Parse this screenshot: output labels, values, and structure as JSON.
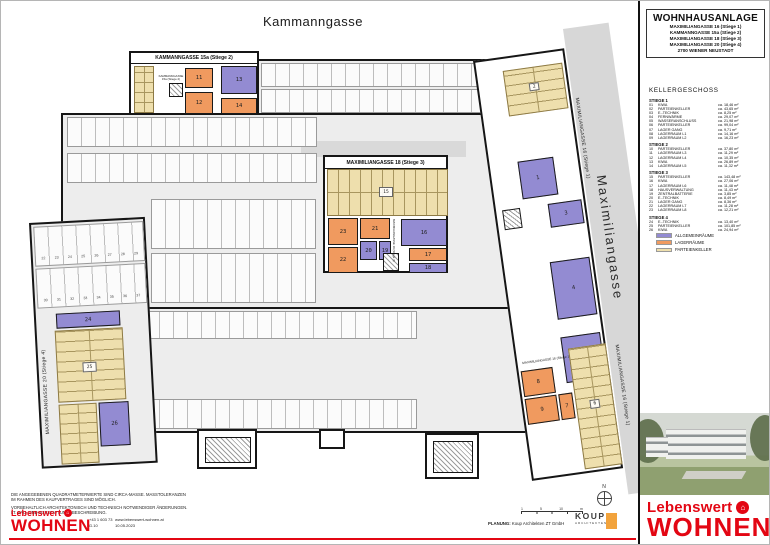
{
  "colors": {
    "c_allgemein": "#938bd2",
    "c_lager": "#f09a5f",
    "c_parteien": "#eedfad",
    "brand_red": "#e30613",
    "koup_orange": "#f2a33c"
  },
  "titleblock": {
    "title": "WOHNHAUSANLAGE",
    "address_lines": [
      "MAXIMILIANGASSE 16 (Stiege 1)",
      "KAMMANNGASSE 15a (Stiege 2)",
      "MAXIMILIANGASSE 18 (Stiege 3)",
      "MAXIMILIANGASSE 20 (Stiege 4)",
      "2700 WIENER NEUSTADT"
    ]
  },
  "room_schedule": {
    "heading": "KELLERGESCHOSS",
    "groups": [
      {
        "label": "STIEGE 1",
        "rooms": [
          {
            "nr": "01",
            "name": "KIWA",
            "area": "ca. 18,46 m²"
          },
          {
            "nr": "02",
            "name": "PARTEIENKELLER",
            "area": "ca. 43,65 m²"
          },
          {
            "nr": "03",
            "name": "E.-TECHNIK",
            "area": "ca. 8,25 m²"
          },
          {
            "nr": "04",
            "name": "FERNWÄRME",
            "area": "ca. 29,07 m²"
          },
          {
            "nr": "05",
            "name": "WASSERANSCHLUSS",
            "area": "ca. 21,98 m²"
          },
          {
            "nr": "06",
            "name": "PARTEIENKELLER",
            "area": "ca. 99,04 m²"
          },
          {
            "nr": "07",
            "name": "LAGER GANG",
            "area": "ca. 9,71 m²"
          },
          {
            "nr": "08",
            "name": "LAGERRAUM L1",
            "area": "ca. 14,16 m²"
          },
          {
            "nr": "09",
            "name": "LAGERRAUM L2",
            "area": "ca. 16,23 m²"
          }
        ]
      },
      {
        "label": "STIEGE 2",
        "rooms": [
          {
            "nr": "10",
            "name": "PARTEIENKELLER",
            "area": "ca. 37,80 m²"
          },
          {
            "nr": "11",
            "name": "LAGERRAUM L3",
            "area": "ca. 11,29 m²"
          },
          {
            "nr": "12",
            "name": "LAGERRAUM L4",
            "area": "ca. 10,35 m²"
          },
          {
            "nr": "13",
            "name": "KIWA",
            "area": "ca. 26,89 m²"
          },
          {
            "nr": "14",
            "name": "LAGERRAUM L5",
            "area": "ca. 11,32 m²"
          }
        ]
      },
      {
        "label": "STIEGE 3",
        "rooms": [
          {
            "nr": "15",
            "name": "PARTEIENKELLER",
            "area": "ca. 143,48 m²"
          },
          {
            "nr": "16",
            "name": "KIWA",
            "area": "ca. 27,06 m²"
          },
          {
            "nr": "17",
            "name": "LAGERRAUM L6",
            "area": "ca. 11,48 m²"
          },
          {
            "nr": "18",
            "name": "HAUSVERWALTUNG",
            "area": "ca. 11,43 m²"
          },
          {
            "nr": "19",
            "name": "ZENTRALBATTERIE",
            "area": "ca. 3,85 m²"
          },
          {
            "nr": "20",
            "name": "E.-TECHNIK",
            "area": "ca. 8,49 m²"
          },
          {
            "nr": "21",
            "name": "LAGER GANG",
            "area": "ca. 8,36 m²"
          },
          {
            "nr": "22",
            "name": "LAGERRAUM L7",
            "area": "ca. 11,28 m²"
          },
          {
            "nr": "23",
            "name": "LAGERRAUM L8",
            "area": "ca. 12,21 m²"
          }
        ]
      },
      {
        "label": "STIEGE 4",
        "rooms": [
          {
            "nr": "24",
            "name": "E.-TECHNIK",
            "area": "ca. 13,40 m²"
          },
          {
            "nr": "25",
            "name": "PARTEIENKELLER",
            "area": "ca. 101,85 m²"
          },
          {
            "nr": "26",
            "name": "KIWA",
            "area": "ca. 24,94 m²"
          }
        ]
      }
    ]
  },
  "legend": {
    "items": [
      {
        "label": "ALLGEMEINRÄUME",
        "color": "#938bd2"
      },
      {
        "label": "LAGERRÄUME",
        "color": "#f09a5f"
      },
      {
        "label": "PARTEIENKELLER",
        "color": "#eedfad"
      }
    ]
  },
  "plan": {
    "street_top": "Kammanngasse",
    "street_right": "Maximiliangasse",
    "edge_label": "MAXIMILIANGASSE 16 (Stiege 1)",
    "s2_header": "KAMMANNGASSE 15a (Stiege 2)",
    "s3_header": "MAXIMILIANGASSE 18 (Stiege 3)",
    "s4_label": "MAXIMILIANGASSE 20 (Stiege 4)",
    "north": "N",
    "rooms": {
      "r1": "1",
      "r2": "2",
      "r3": "3",
      "r4": "4",
      "r5": "5",
      "r6": "6",
      "r7": "7",
      "r8": "8",
      "r9": "9",
      "r11": "11",
      "r12": "12",
      "r13": "13",
      "r14": "14",
      "r15": "15",
      "r16": "16",
      "r17": "17",
      "r18": "18",
      "r19": "19",
      "r20": "20",
      "r21": "21",
      "r22": "22",
      "r23": "23",
      "r24": "24",
      "r25": "25",
      "r26": "26"
    },
    "parking_rows": [
      [
        "22",
        "23",
        "24",
        "25",
        "26",
        "27",
        "28",
        "29"
      ],
      [
        "30",
        "31",
        "32",
        "33",
        "34",
        "35",
        "36",
        "37"
      ]
    ]
  },
  "brand": {
    "line1": "Lebenswert",
    "line2": "WOHNEN",
    "house_glyph": "⌂"
  },
  "footer": {
    "disclaimer_lines": [
      "DIE ANGEGEBENEN QUADRATMETERWERTE SIND CIRCA-MASSE. MASSTOLERANZEN",
      "IM RAHMEN DES KAUFVERTRAGES SIND MÖGLICH.",
      "VORBEHALTLICH ARCHITEKTONISCH UND TECHNISCH NOTWENDIGER ÄNDERUNGEN.",
      "LT. BAU- UND AUSSTATTUNGSBESCHREIBUNG."
    ],
    "phone": "+43 1 603 73",
    "unit": "G.10",
    "web": "www.lebenswert-wohnen.at",
    "date": "10.05.2023",
    "planung_label": "PLANUNG:",
    "planung_value": "Koup Architekten ZT GmbH",
    "koup_name": "KOUP",
    "koup_sub": "ARCHITEKTEN",
    "scale_labels": [
      "1",
      "5",
      "10",
      "m"
    ]
  }
}
